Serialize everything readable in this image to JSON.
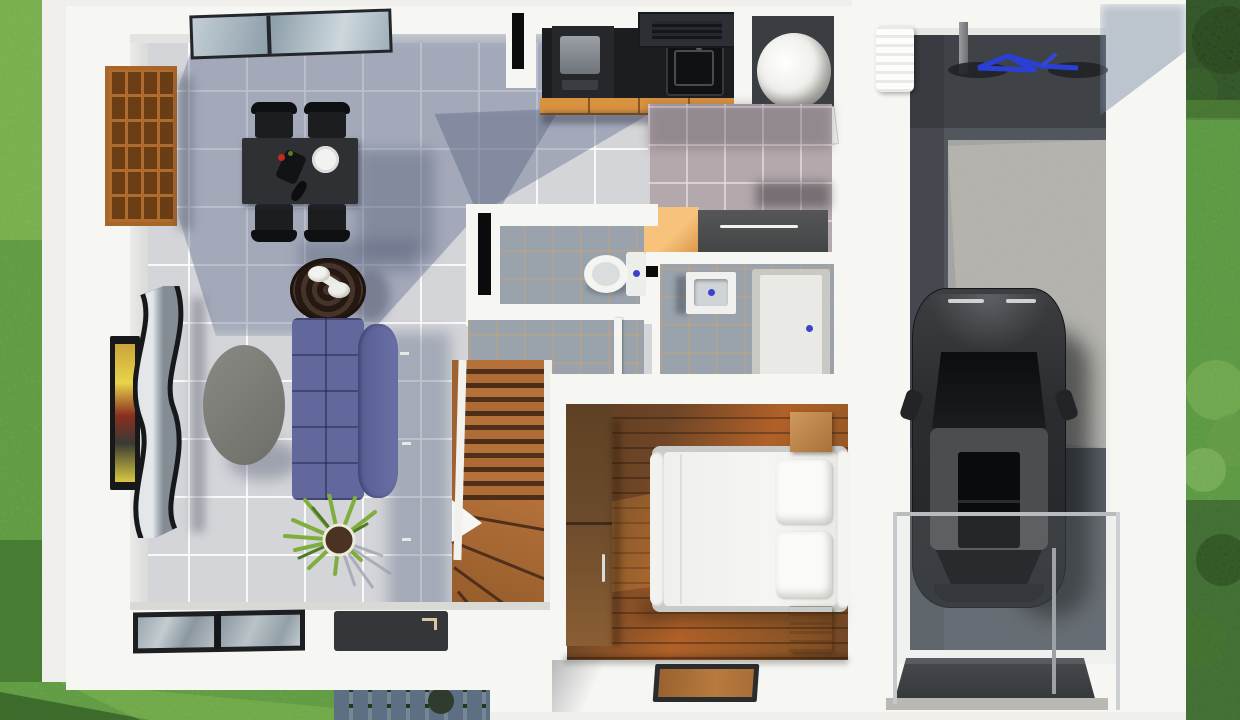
{
  "meta": {
    "label": "3D rendered top-down floor plan of a small two-storey house with side garage",
    "view": "top-down architectural render",
    "floor": "ground floor"
  },
  "palette": {
    "ground": "#f0efec",
    "wall": "#f6f6f3",
    "wallFace": "#e3e4e2",
    "tile": "#d4d5d9",
    "tileShadow": "#6e7f9e",
    "bathTile": "#9aa3ac",
    "mauveTile": "#b3a8ac",
    "grassBase": "#74ac47",
    "grassDark": "#3f7a2e",
    "foliageDark": "#24391f",
    "bushGreen": "#6fa04a",
    "cobble": "#5c6f83",
    "cobbleJoint": "#3a4a31",
    "gravel": "#5b6067",
    "gravelLit": "#9a948a",
    "counter": "#1b1d20",
    "cabinet": "#d9923f",
    "hood": "#2c2f34",
    "bookshelf": "#a8652a",
    "cubby": "#6b3d15",
    "tableDark": "#2e3033",
    "chairBlack": "#1c1d1f",
    "plateWhite": "#f2f2f0",
    "sofa": "#63689c",
    "sofaDark": "#4e5384",
    "coffeeTable": "#7d7d77",
    "trayTable": "#3a2b20",
    "tvSilver": "#aeb6bc",
    "tvFrame": "#17181a",
    "screenYellow": "#e8d44a",
    "screenRed": "#8a2e20",
    "plantGreen": "#7fae3e",
    "potBrown": "#4a3322",
    "stairWood": "#b5713a",
    "stairShadow": "#50301a",
    "woodDark": "#5e3c22",
    "woodMid": "#8a5526",
    "woodLit": "#b06128",
    "wardrobe": "#7a552f",
    "nightstand": "#c08b52",
    "frameGray": "#c9cbca",
    "mattress": "#f5f5f3",
    "matDark": "#2b2c2e",
    "matCenter": "#a96e38",
    "orangeFloor": "#f2bc76",
    "dresser": "#4a4a4c",
    "heaterFloor": "#3a3d41",
    "cylWhite": "#f2f2ee",
    "toiletWhite": "#f4f4f1",
    "drainBlue": "#3b43cc",
    "carBody": "#2b2d30",
    "carRoof": "#4b4d50",
    "carGlass": "#0e0f12",
    "bikeBlue": "#2a3fd4",
    "railGray": "#b9bcbe",
    "glassTint": "rgba(200,215,222,0.14)",
    "windowGlass": "#9aa6ad",
    "sillGray": "#b9b8b3"
  },
  "scene": {
    "yard_left": {
      "label": "side lawn",
      "features": [
        "grass",
        "cobblestone path",
        "building shadow"
      ]
    },
    "yard_right": {
      "label": "garden strip",
      "features": [
        "tree canopy",
        "lawn",
        "bushes"
      ]
    },
    "house": {
      "rooms": [
        {
          "name": "living-dining room",
          "floor": "light gray ceramic tile",
          "furniture": [
            "bookshelf",
            "dining table",
            "4 dining chairs",
            "teapot",
            "plate",
            "wall tv",
            "wavy tv console",
            "oval coffee table",
            "round tray table",
            "corner sofa",
            "potted plant",
            "skylight window",
            "sliding window",
            "interior doormat"
          ]
        },
        {
          "name": "kitchen",
          "furniture": [
            "black countertop",
            "cooktop",
            "sink",
            "range hood",
            "orange base cabinets"
          ]
        },
        {
          "name": "utility closet",
          "furniture": [
            "water heater cylinder",
            "open door"
          ]
        },
        {
          "name": "hallway",
          "floor": "mauve tile",
          "furniture": [
            "dark sideboard",
            "orange wood floor patch"
          ]
        },
        {
          "name": "wc",
          "furniture": [
            "toilet"
          ]
        },
        {
          "name": "bathroom",
          "furniture": [
            "washbasin",
            "shower tray"
          ]
        },
        {
          "name": "staircase",
          "furniture": [
            "straight flight",
            "winder steps"
          ]
        },
        {
          "name": "bedroom",
          "floor": "wood plank",
          "furniture": [
            "double bed",
            "2 pillows",
            "2 nightstands",
            "wardrobe",
            "entrance doormat"
          ]
        }
      ]
    },
    "garage": {
      "label": "open carport",
      "floor": "gravel",
      "contents": [
        "black hatchback car",
        "bicycle",
        "support pole",
        "ac unit",
        "glass railing",
        "rubber driveway mat"
      ]
    }
  }
}
